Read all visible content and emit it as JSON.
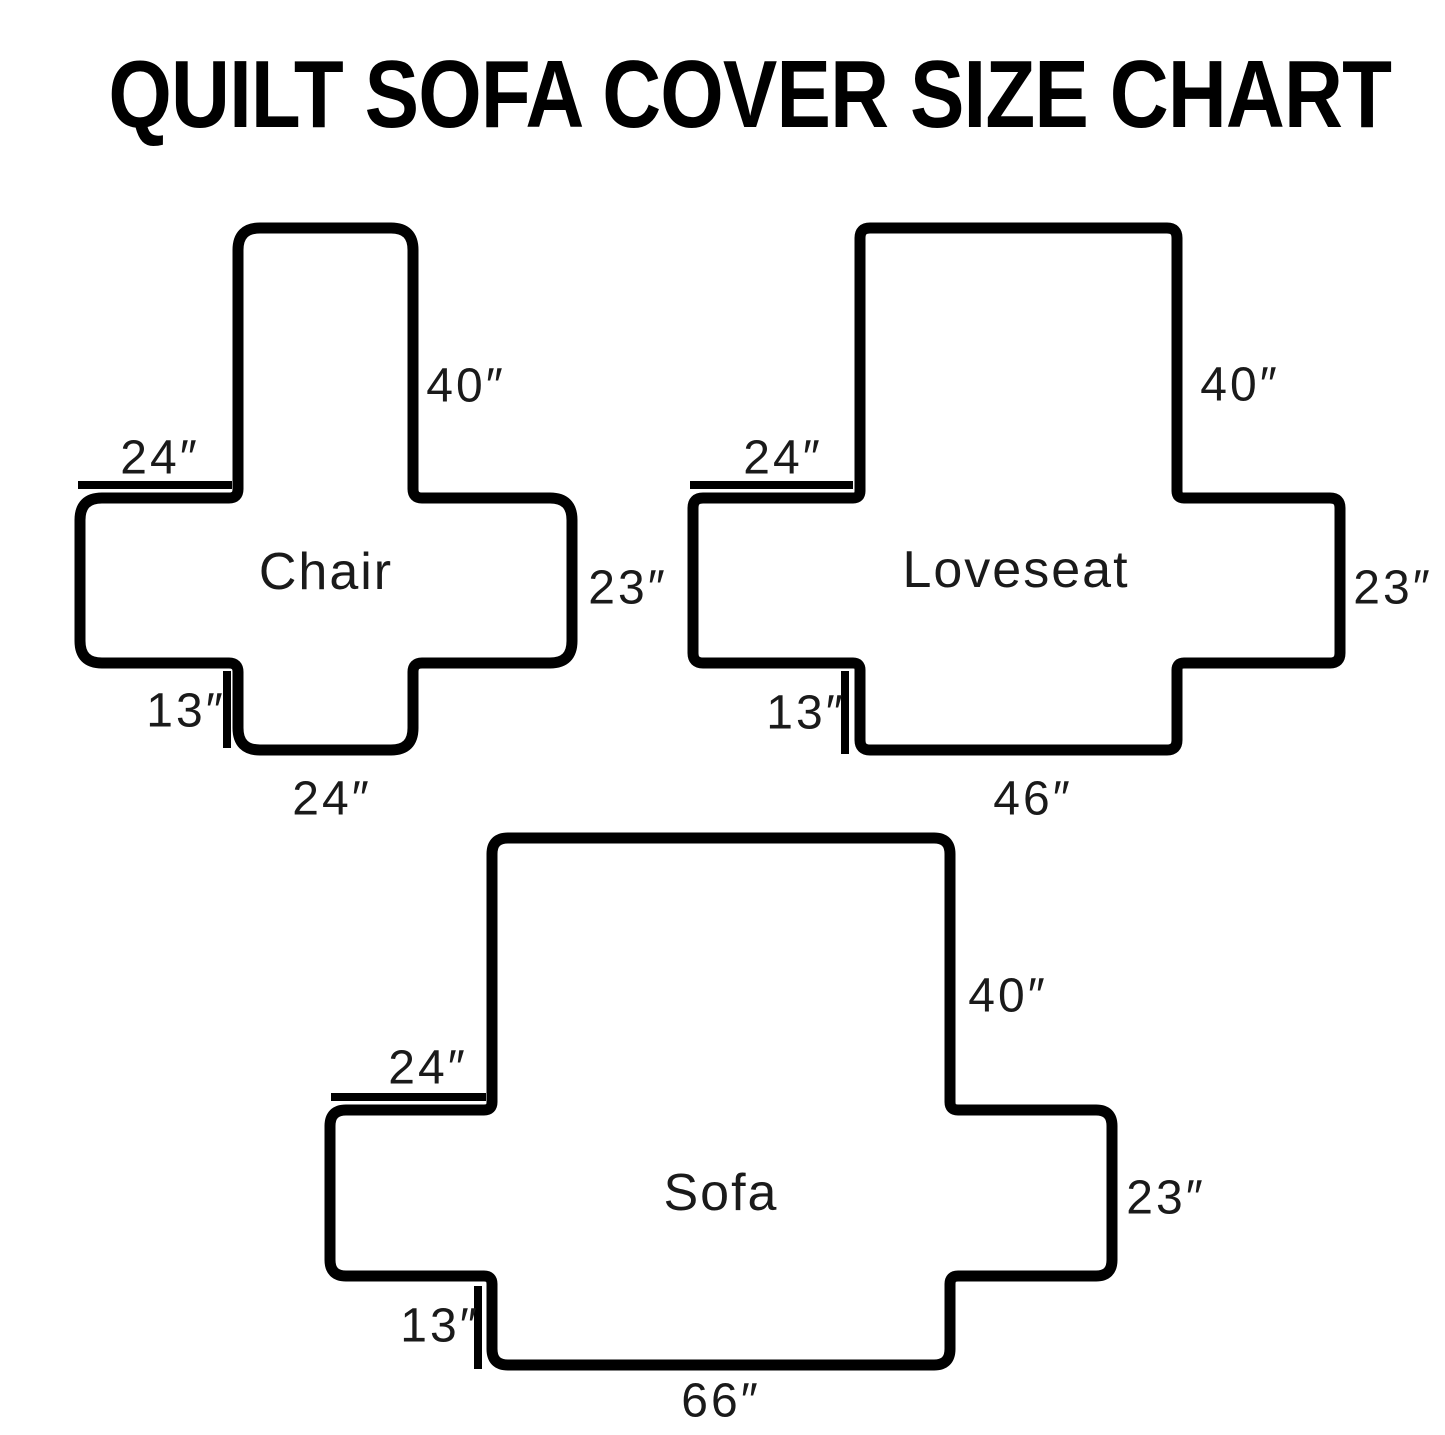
{
  "title": "QUILT SOFA COVER SIZE CHART",
  "colors": {
    "ink": "#000000",
    "label_ink": "#1a1a1a",
    "background": "#ffffff"
  },
  "diagrams": {
    "chair": {
      "name": "Chair",
      "back_height": "40″",
      "arm_width": "24″",
      "side_height": "23″",
      "skirt_drop": "13″",
      "seat_width": "24″"
    },
    "loveseat": {
      "name": "Loveseat",
      "back_height": "40″",
      "arm_width": "24″",
      "side_height": "23″",
      "skirt_drop": "13″",
      "seat_width": "46″"
    },
    "sofa": {
      "name": "Sofa",
      "back_height": "40″",
      "arm_width": "24″",
      "side_height": "23″",
      "skirt_drop": "13″",
      "seat_width": "66″"
    }
  }
}
